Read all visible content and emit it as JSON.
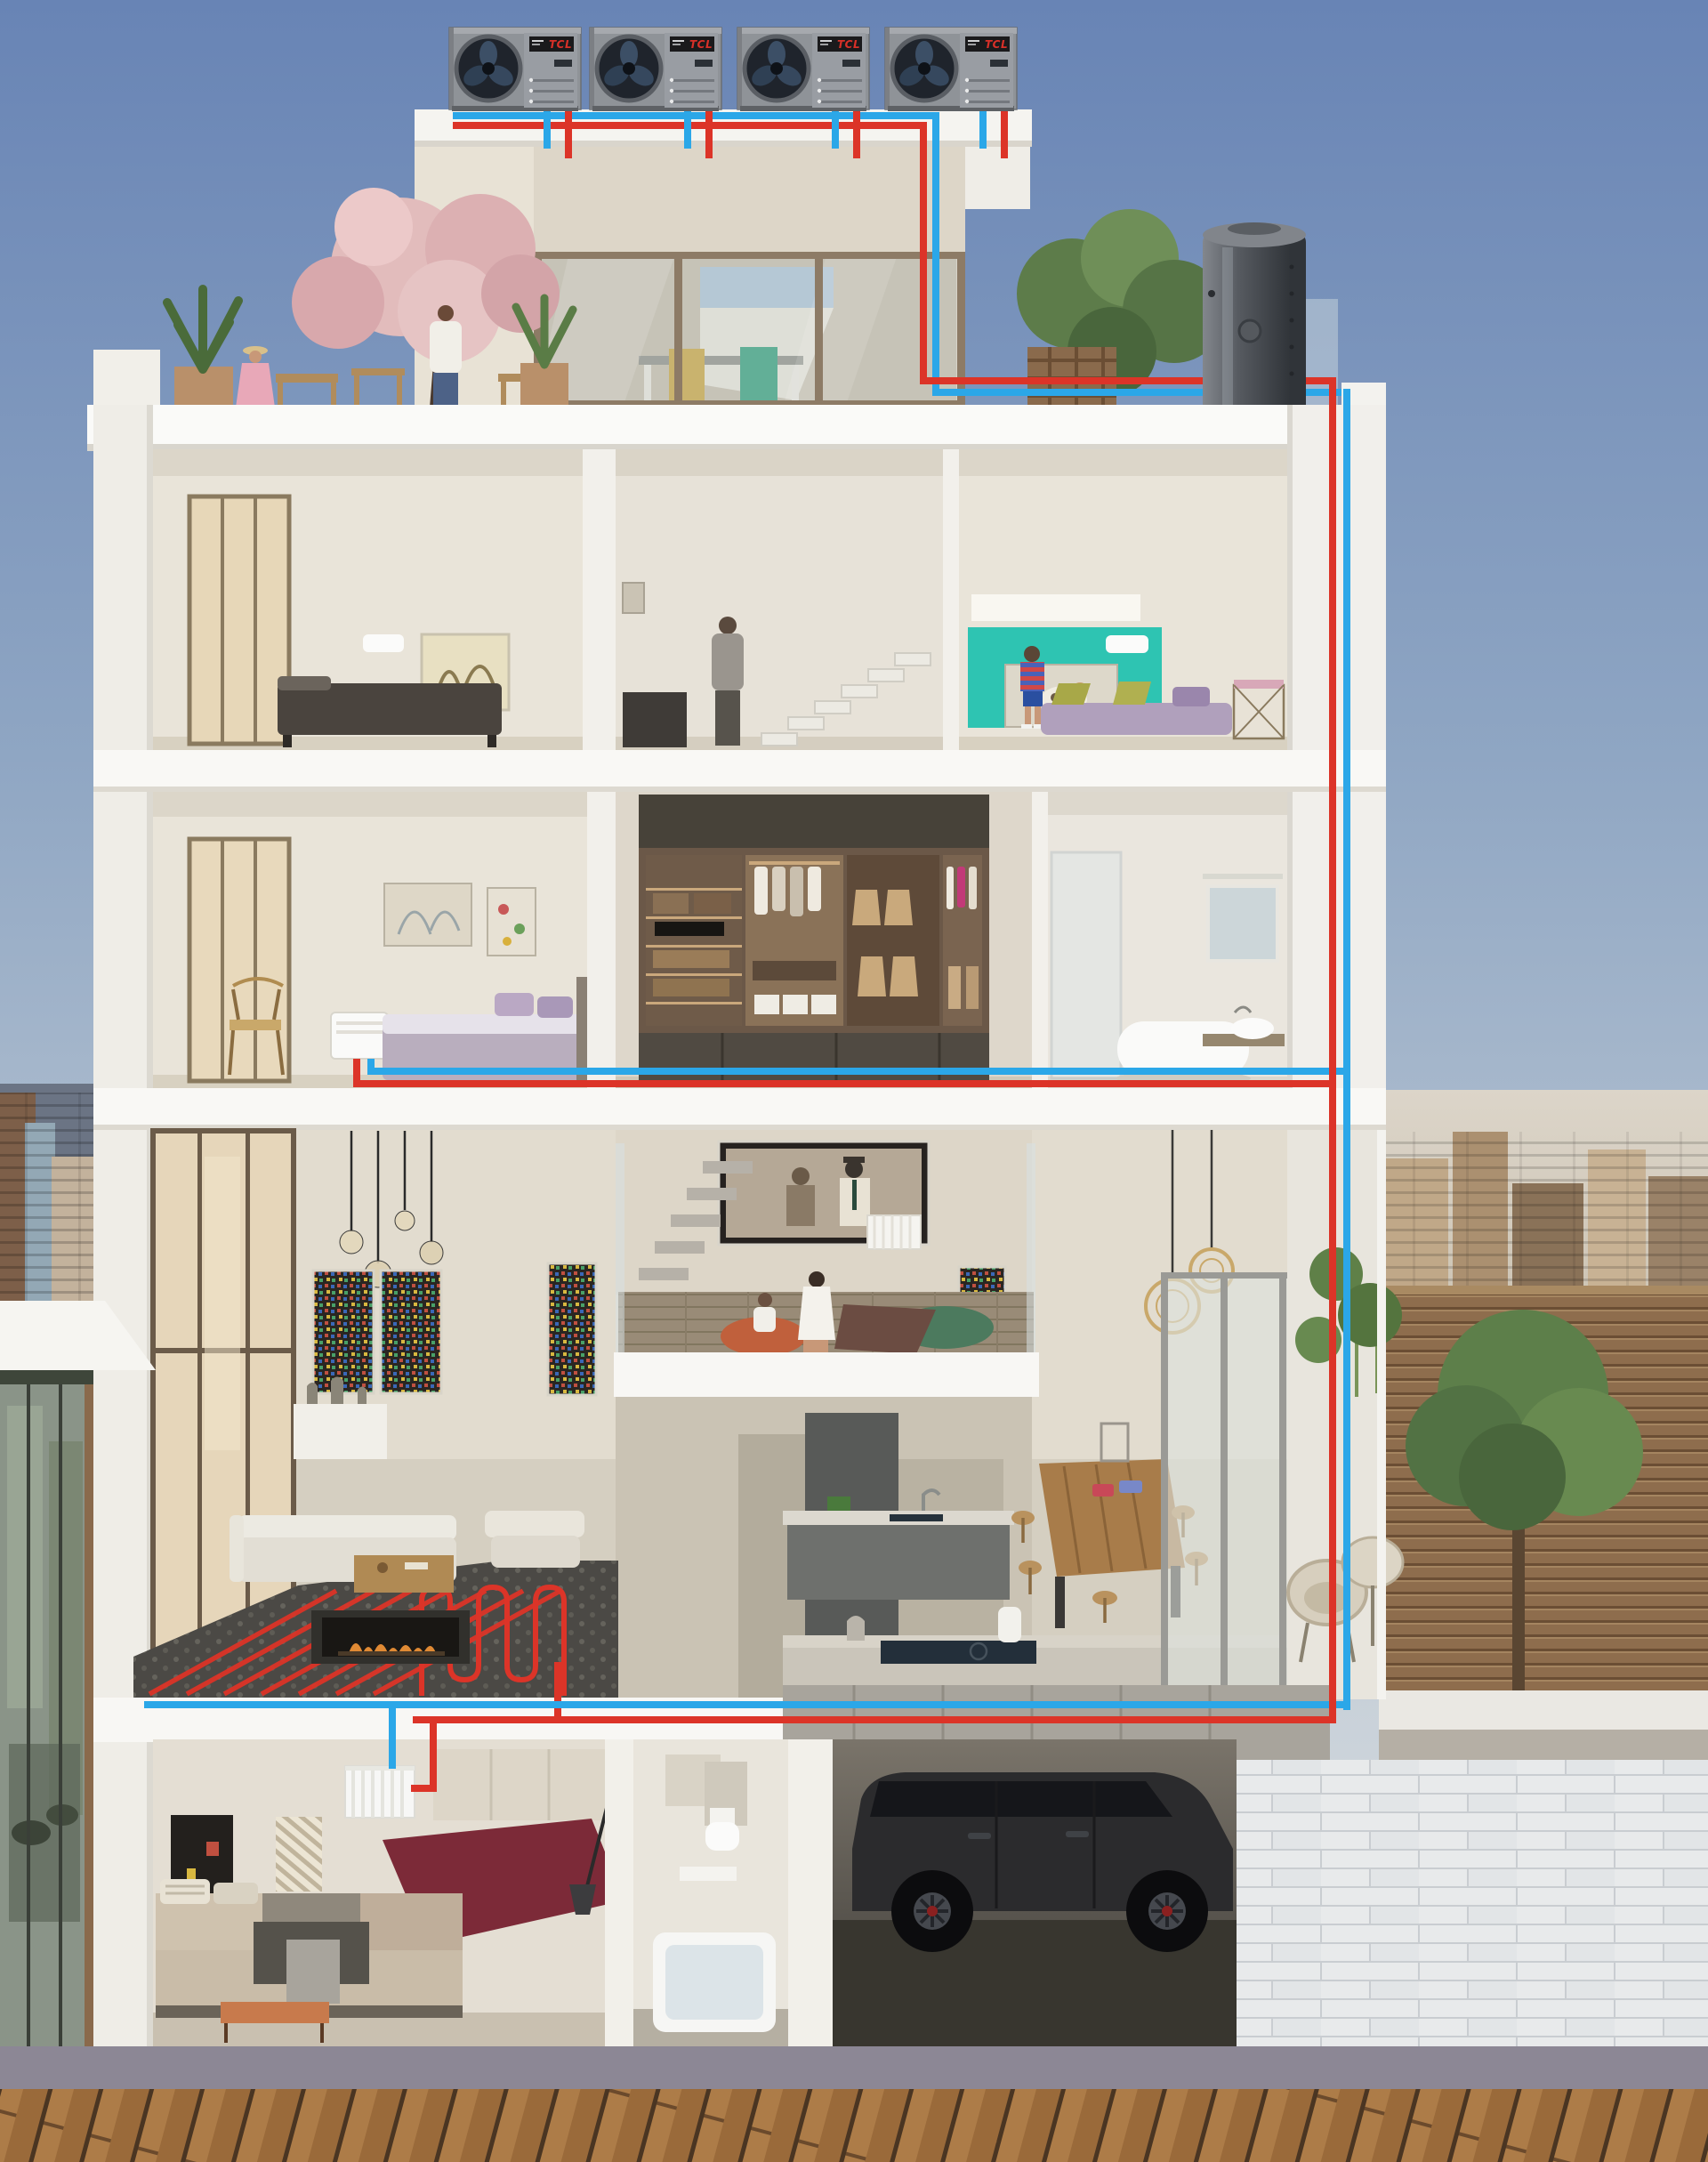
{
  "scene": {
    "title": "Whole-house heat-pump heating & cooling cutaway",
    "image_type": "3D architectural cross-section illustration",
    "description": "Five-level townhouse cutaway showing four TCL rooftop monobloc air-source heat pumps feeding a rooftop hot-water buffer tank, with red (hot/supply) and blue (cold/return) piping distributing to wall AC units, a fan coil, radiators and underfloor heating; basement garage with a dark SUV; city skyline and timber deck in background."
  },
  "equipment": {
    "heat_pump": {
      "brand": "TCL",
      "count": 4,
      "type": "rooftop monobloc air-source heat pump",
      "body_color": "#8f9398",
      "fan_color": "#1f242c",
      "label_bg": "#1a1a1c",
      "label_text_color": "#d83028"
    },
    "buffer_tank": {
      "name": "hot-water storage tank",
      "color": "#4a4e54",
      "location": "roof terrace, right side"
    },
    "indoor_units": [
      {
        "name": "wall AC unit",
        "room": "fourth-floor bedroom"
      },
      {
        "name": "wall AC unit",
        "room": "fourth-floor kids room"
      },
      {
        "name": "fan coil unit",
        "room": "third-floor master bedroom"
      },
      {
        "name": "panel radiator",
        "room": "mezzanine TV loft"
      },
      {
        "name": "underfloor heating coil",
        "room": "ground-floor living room"
      },
      {
        "name": "panel radiator",
        "room": "basement bedroom"
      }
    ]
  },
  "pipes": {
    "supply": {
      "color": "#dc3428",
      "label": "hot / supply line"
    },
    "return": {
      "color": "#2ba7e8",
      "label": "cold / return line"
    }
  },
  "floors": [
    {
      "name": "roof level",
      "rooms": [
        "heat-pump platform",
        "roof terrace with cherry tree",
        "penthouse study",
        "tank terrace"
      ]
    },
    {
      "name": "fourth floor",
      "rooms": [
        "bedroom",
        "stair hall",
        "kids room with teal wall"
      ]
    },
    {
      "name": "third floor",
      "rooms": [
        "master bedroom",
        "walk-in closet",
        "bathroom"
      ]
    },
    {
      "name": "ground floor (double height)",
      "rooms": [
        "living room with fireplace",
        "TV mezzanine",
        "kitchen and dining",
        "side terrace"
      ]
    },
    {
      "name": "basement",
      "rooms": [
        "guest bedroom",
        "bathroom",
        "garage"
      ]
    }
  ],
  "figures": [
    "man standing on roof terrace",
    "woman seated on roof terrace",
    "man in stair hall",
    "boy in kids room",
    "woman and child on mezzanine beanbags"
  ],
  "vehicle": "dark SUV parked in basement garage",
  "background": {
    "sky": "clear blue, lighter toward horizon",
    "left": "dense city skyline",
    "right": "hazy city skyline and neighbouring roof terrace with timber slat wall and tree",
    "bottom": "grey kerb and diagonal timber deck promenade"
  },
  "palette": {
    "sky_top": "#6884b5",
    "wall_white": "#f4f3ef",
    "room_beige": "#e9e4d9",
    "teal_accent": "#2ec4b2",
    "deck_wood": "#ad7c48",
    "tile_wall": "#e8eaeb"
  }
}
